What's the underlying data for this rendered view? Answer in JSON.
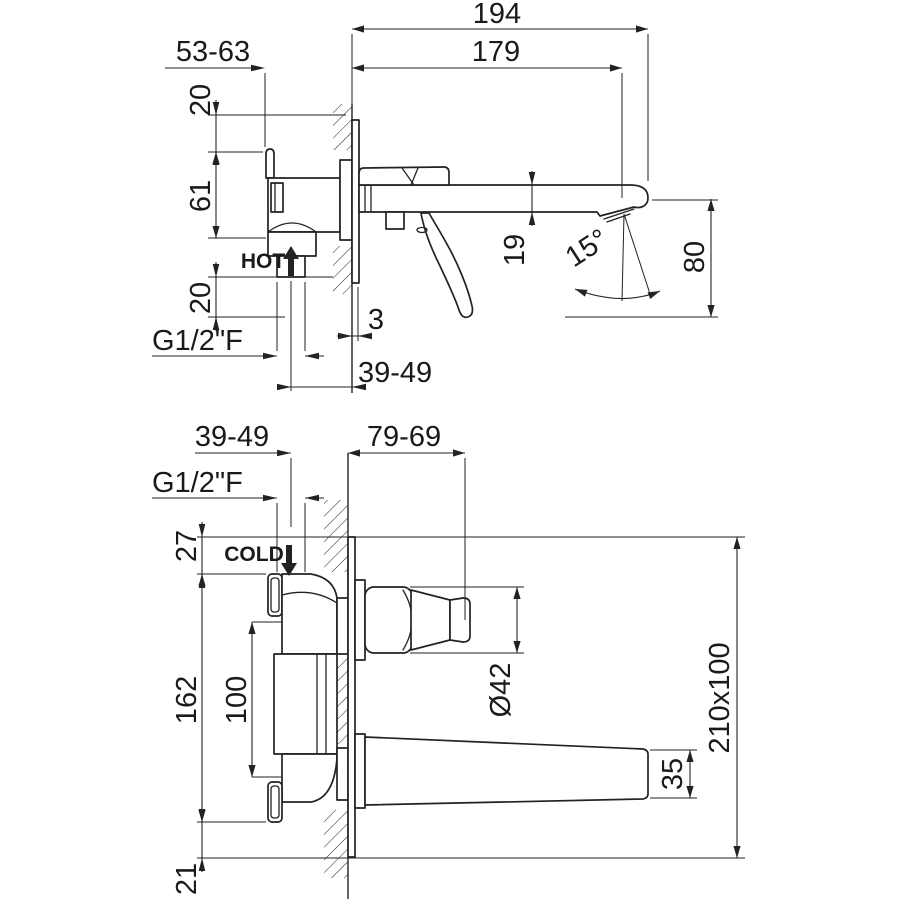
{
  "side_view": {
    "d194": "194",
    "d179": "179",
    "d53_63": "53-63",
    "d20_top": "20",
    "d61": "61",
    "d20_bottom": "20",
    "hot": "HOT",
    "thread": "G1/2\"F",
    "d3": "3",
    "d39_49": "39-49",
    "d19": "19",
    "angle": "15°",
    "d80": "80"
  },
  "front_view": {
    "d39_49": "39-49",
    "d79_69": "79-69",
    "thread": "G1/2\"F",
    "cold": "COLD",
    "d27": "27",
    "d162": "162",
    "d100": "100",
    "d21": "21",
    "dia42": "Ø42",
    "d35": "35",
    "plate_size": "210x100"
  },
  "colors": {
    "line": "#222222",
    "background": "#ffffff"
  }
}
